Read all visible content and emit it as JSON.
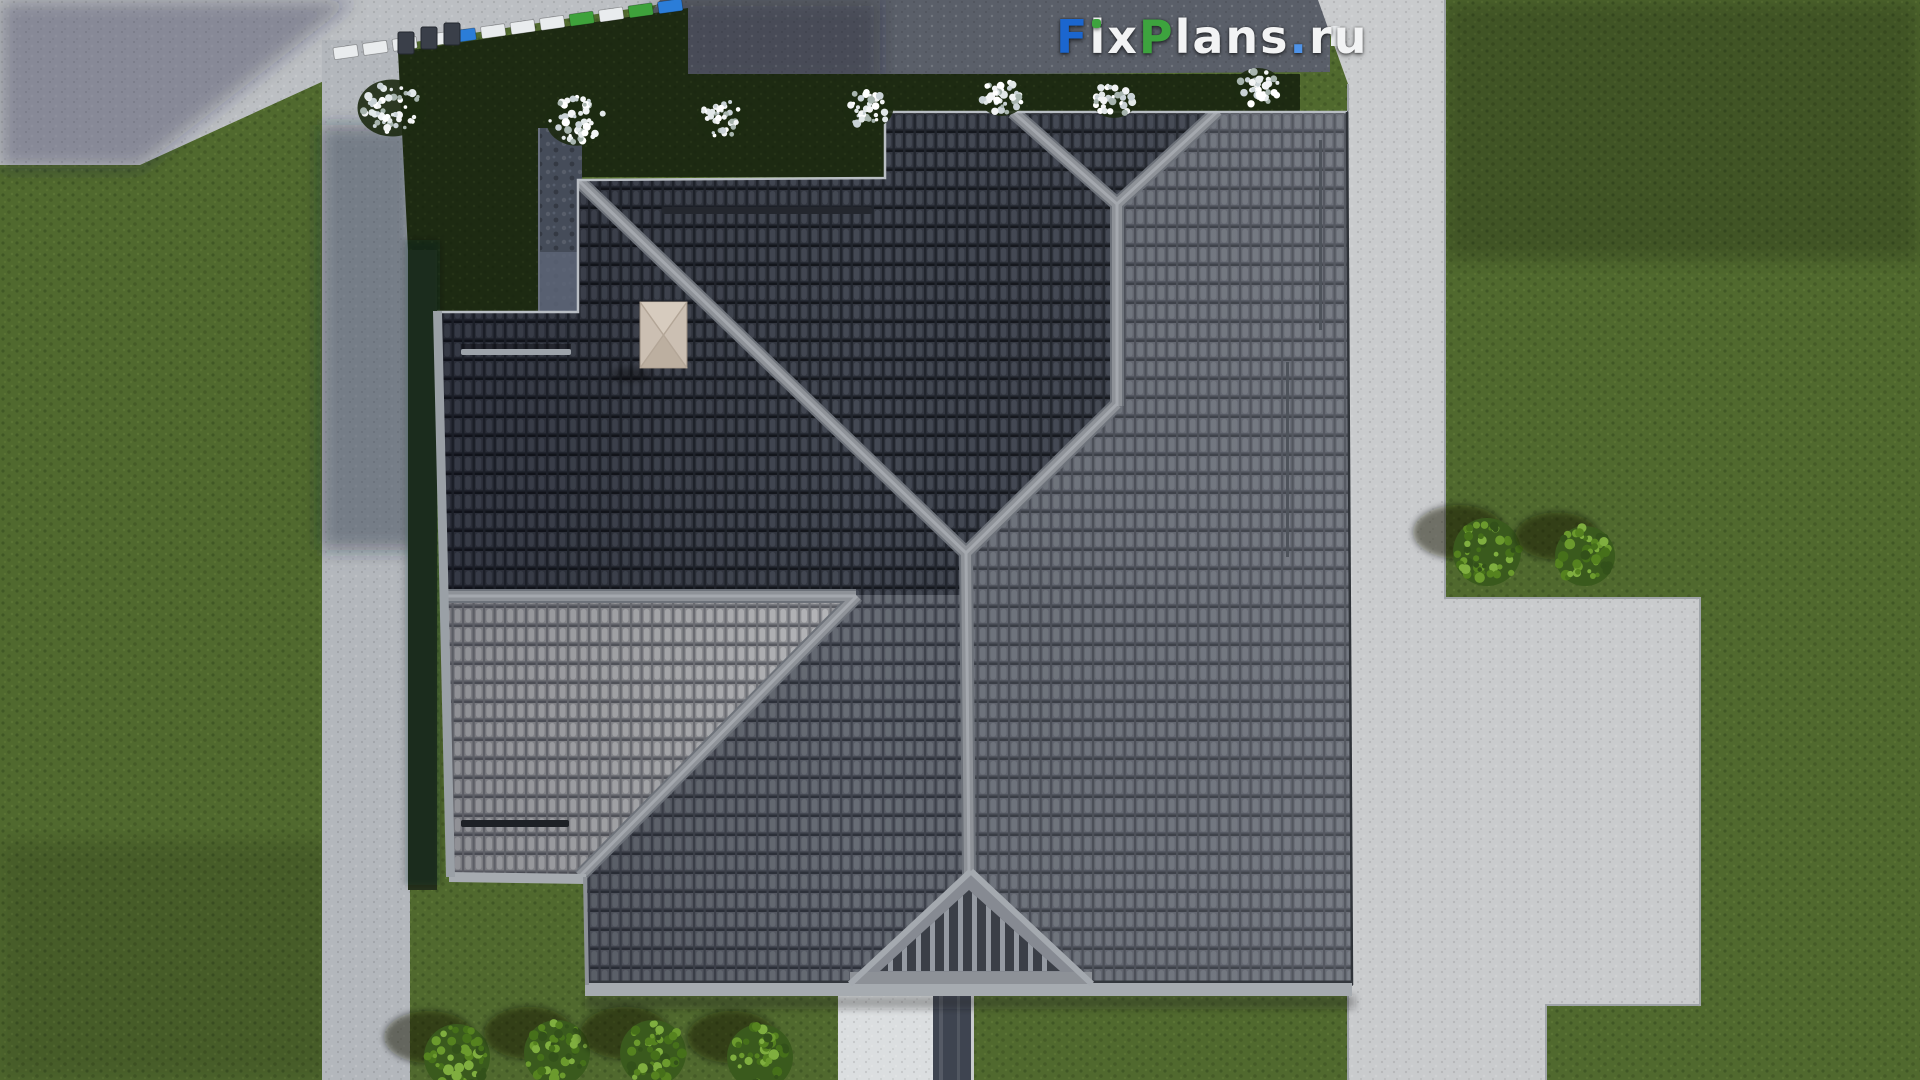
{
  "watermark": {
    "text": "FixPlans.ru",
    "parts": [
      {
        "text": "F",
        "style": "color:#1b66cf"
      },
      {
        "text": "ix",
        "style": "color:#f2f3f4"
      },
      {
        "text": "P",
        "style": "color:#3da33e"
      },
      {
        "text": "lans",
        "style": "color:#f2f3f4"
      },
      {
        "text": ".",
        "style": "color:#4f93e8"
      },
      {
        "text": "ru",
        "style": "color:#f2f3f4"
      }
    ],
    "i_dot_color": "#3da33e"
  },
  "scene": {
    "colors": {
      "lawn": "#50692e",
      "lawn_shadow_strip": "#26321c",
      "hedge_bed": "#1d2a12",
      "street": "#bcbfc3",
      "road": "#b3b7bc",
      "dark_pavement": "#5a5f69",
      "concrete": "#c9cbcd",
      "roof_dark": "#343842",
      "roof_medium": "#585c66",
      "roof_light": "#97989c",
      "ridge_cap": "#8e9298",
      "fascia": "#a6abb0",
      "chimney": "#cbbfb2",
      "walk_white": "#dbdee0",
      "walk_runner": "#3e4450",
      "stone_path": "#454c59",
      "bush_green": "#55821f",
      "shrub_white": "#eef1f2",
      "fence_white": "#e9ecee",
      "fence_blue": "#2b7dd8",
      "fence_green": "#3ea23b",
      "fence_post": "#373c45"
    },
    "green_bushes": [
      {
        "cx": 1487,
        "cy": 552,
        "r": 34
      },
      {
        "cx": 1585,
        "cy": 556,
        "r": 30
      },
      {
        "cx": 457,
        "cy": 1057,
        "r": 33
      },
      {
        "cx": 557,
        "cy": 1053,
        "r": 33
      },
      {
        "cx": 653,
        "cy": 1053,
        "r": 33
      },
      {
        "cx": 760,
        "cy": 1057,
        "r": 33
      }
    ],
    "white_shrubs": [
      {
        "cx": 392,
        "cy": 108,
        "r": 30
      },
      {
        "cx": 577,
        "cy": 120,
        "r": 27
      },
      {
        "cx": 722,
        "cy": 118,
        "r": 22
      },
      {
        "cx": 868,
        "cy": 108,
        "r": 22
      },
      {
        "cx": 1002,
        "cy": 97,
        "r": 20
      },
      {
        "cx": 1114,
        "cy": 99,
        "r": 20
      },
      {
        "cx": 1258,
        "cy": 88,
        "r": 21
      }
    ],
    "fence": {
      "x1": 332,
      "y1": 54,
      "x2": 686,
      "y2": 4,
      "panels": [
        "white",
        "white",
        "white",
        "white",
        "blue",
        "white",
        "white",
        "white",
        "green",
        "white",
        "green",
        "blue"
      ]
    },
    "bins": [
      {
        "x": 398,
        "y": 32
      },
      {
        "x": 421,
        "y": 27
      },
      {
        "x": 444,
        "y": 23
      }
    ]
  }
}
